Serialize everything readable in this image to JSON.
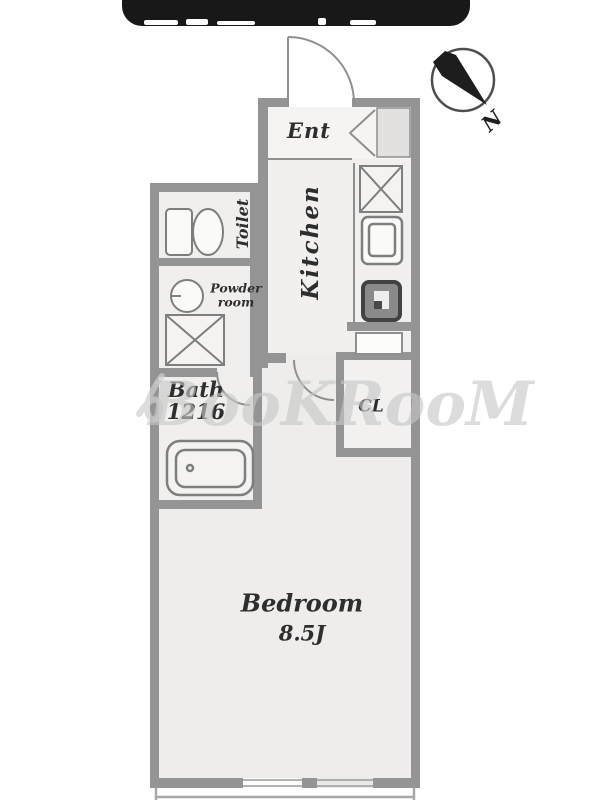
{
  "plan": {
    "rooms": {
      "entrance": {
        "label": "Ent"
      },
      "kitchen": {
        "label": "Kitchen"
      },
      "toilet": {
        "label": "Toilet"
      },
      "powder_room": {
        "line1": "Powder",
        "line2": "room"
      },
      "bathroom": {
        "line1": "Bath",
        "line2": "1216"
      },
      "closet": {
        "label": "CL"
      },
      "bedroom": {
        "line1": "Bedroom",
        "line2": "8.5J"
      }
    },
    "compass": {
      "label": "N"
    },
    "watermark": {
      "text": "BooKRooM"
    },
    "colors": {
      "wall": "#949494",
      "floor": "#f0efed",
      "header_bar": "#181818",
      "watermark": "#c7c7c7",
      "fixture_stroke": "#7e7e7e"
    }
  }
}
